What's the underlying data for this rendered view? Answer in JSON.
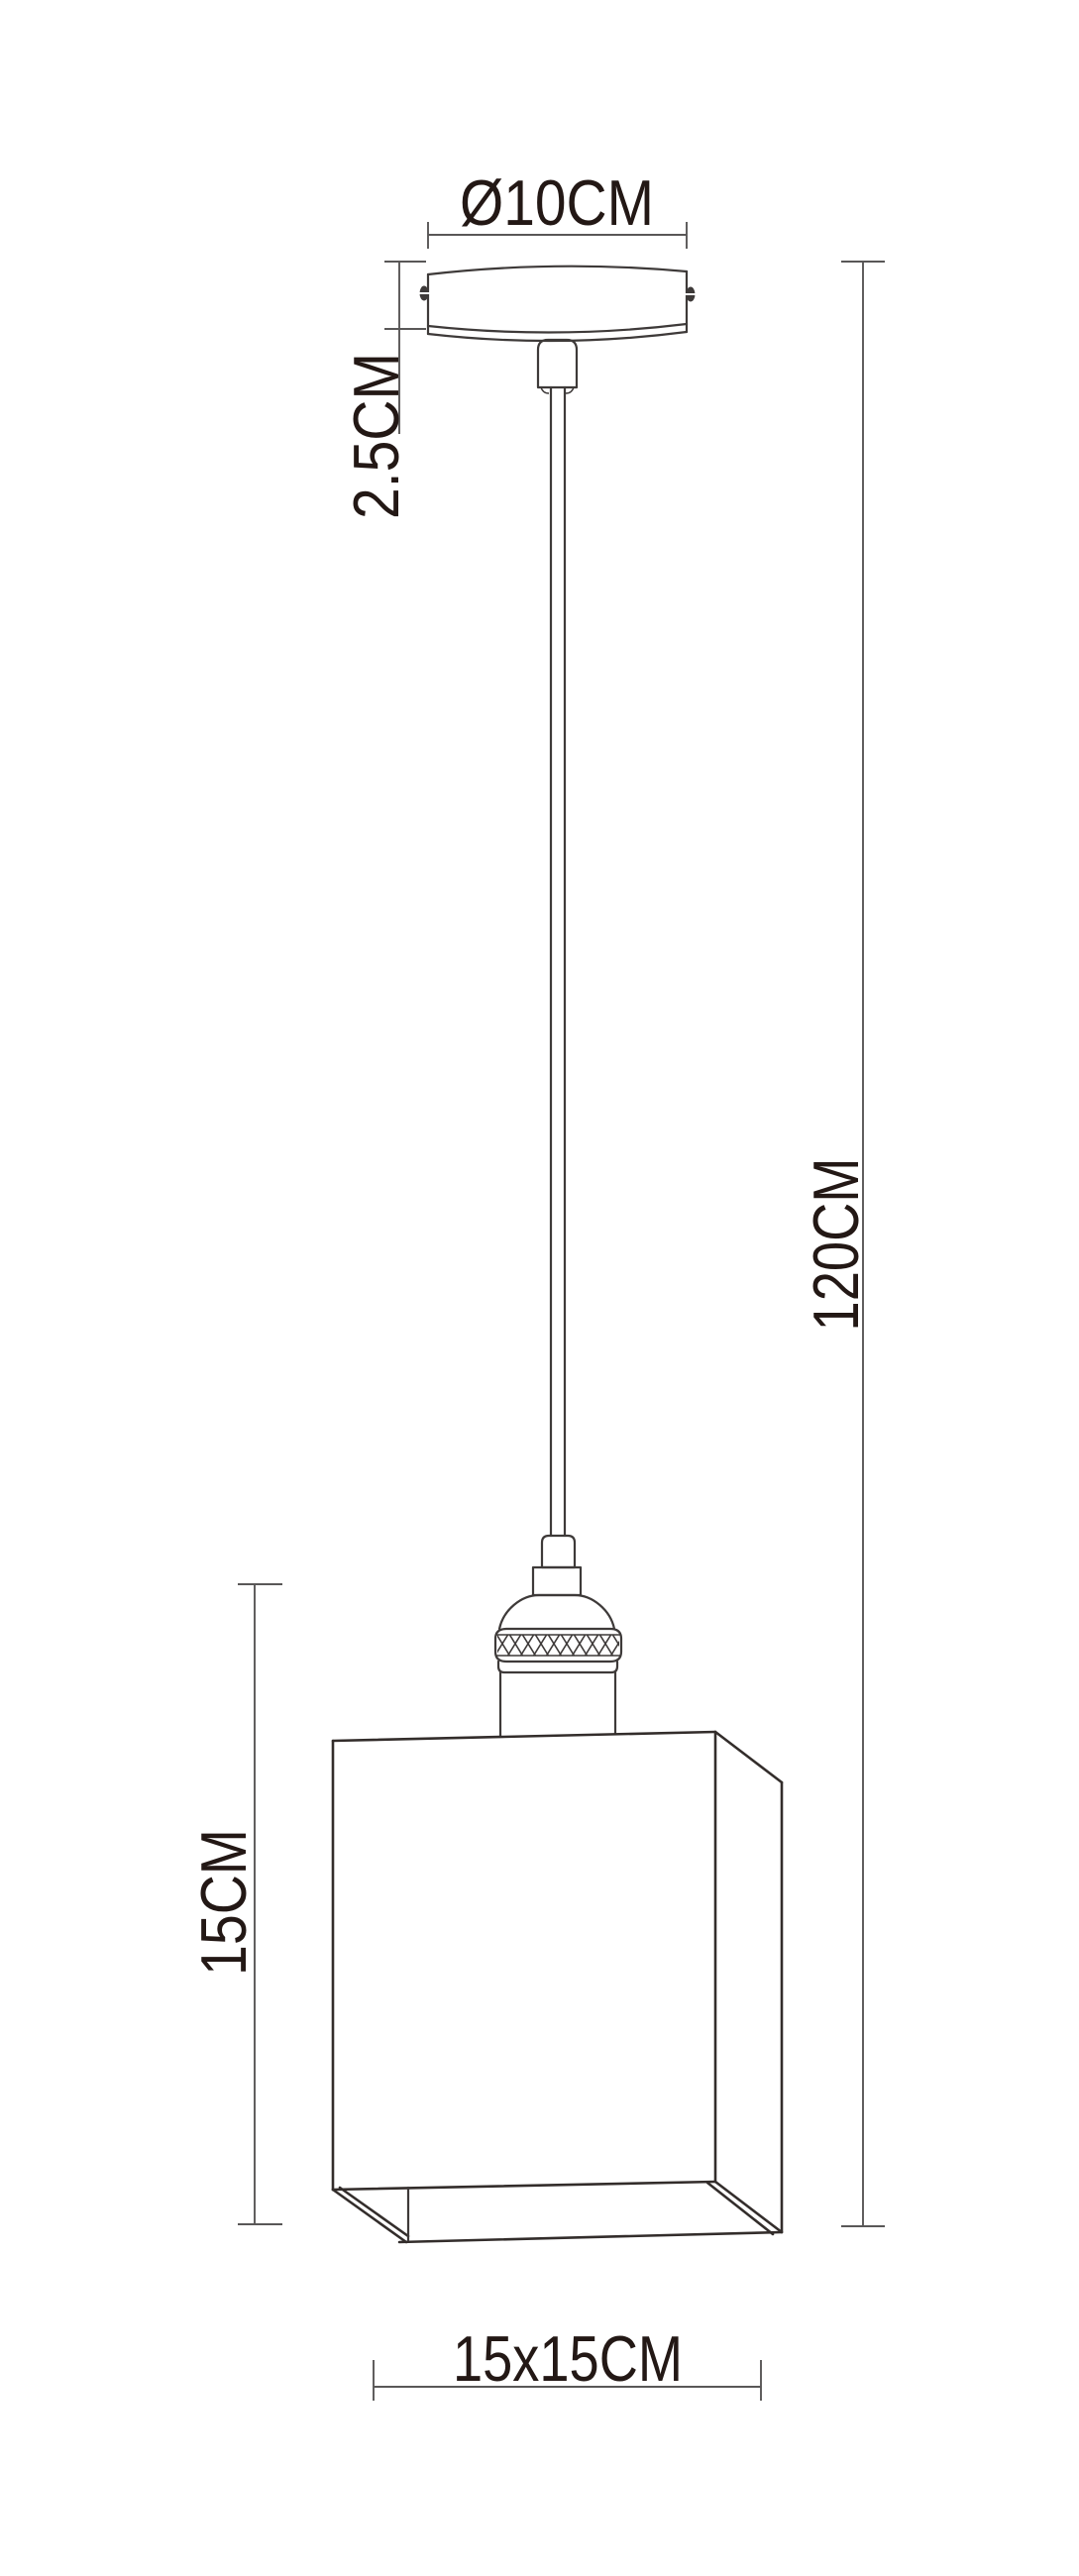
{
  "diagram_labels": {
    "canopy_diameter": "Ø10CM",
    "canopy_height": "2.5CM",
    "drop_height": "120CM",
    "shade_height": "15CM",
    "shade_footprint": "15x15CM"
  },
  "colors": {
    "background": "#ffffff",
    "drawing_line": "#3e3a39",
    "dimension_line": "#595757",
    "label_text": "#231815"
  }
}
